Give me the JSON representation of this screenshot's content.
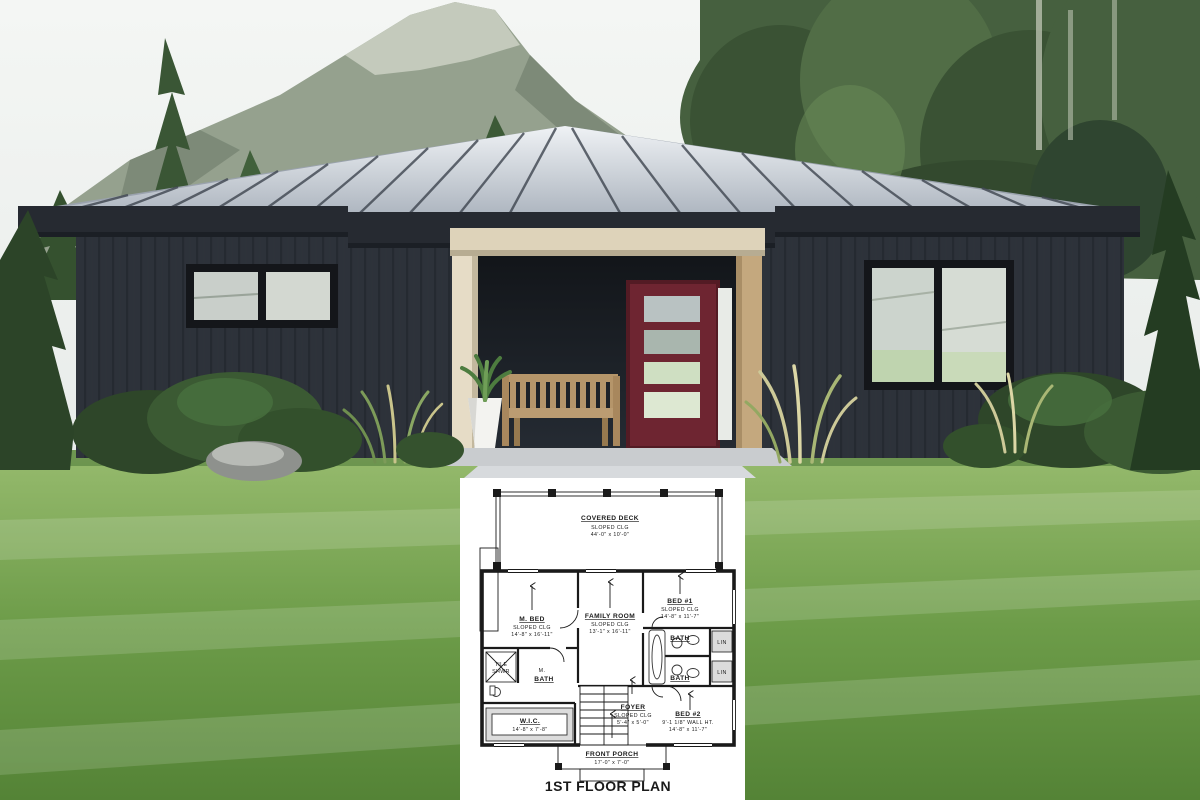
{
  "palette": {
    "sky": "#eef0ef",
    "mountain": "#93a08d",
    "forest": "#47603e",
    "roof_metal": "#c9d0d8",
    "fascia": "#262a31",
    "siding": "#2d323a",
    "porch_trim": "#ded3ba",
    "porch_wood": "#c4a87e",
    "front_door": "#6e2531",
    "lawn": "#6fa04c",
    "plan_ink": "#1a1a1a"
  },
  "floor_plan": {
    "caption": "1ST FLOOR PLAN",
    "covered_deck": {
      "name": "COVERED DECK",
      "ceiling": "SLOPED CLG",
      "dims": "44'-0\" x 10'-0\""
    },
    "m_bed": {
      "name": "M. BED",
      "ceiling": "SLOPED CLG",
      "dims": "14'-8\" x 16'-11\""
    },
    "family_room": {
      "name": "FAMILY ROOM",
      "ceiling": "SLOPED CLG",
      "dims": "13'-1\" x 16'-11\""
    },
    "bed_1": {
      "name": "BED #1",
      "ceiling": "SLOPED CLG",
      "dims": "14'-8\" x 11'-7\""
    },
    "bath_upper": {
      "name": "BATH"
    },
    "bath_lower": {
      "name": "BATH"
    },
    "lin_upper": {
      "name": "LIN"
    },
    "lin_lower": {
      "name": "LIN"
    },
    "tile_shwr": {
      "line1": "TILE",
      "line2": "SHWR"
    },
    "m_bath": {
      "line1": "M.",
      "line2": "BATH"
    },
    "wic": {
      "name": "W.I.C.",
      "dims": "14'-8\" x 7'-8\""
    },
    "foyer": {
      "name": "FOYER",
      "ceiling": "SLOPED CLG",
      "dims": "5'-4\" x 5'-0\""
    },
    "bed_2": {
      "name": "BED #2",
      "wall_height": "9'-1 1/8\" WALL HT.",
      "dims": "14'-8\" x 11'-7\""
    },
    "front_porch": {
      "name": "FRONT PORCH",
      "dims": "17'-0\" x 7'-0\""
    }
  }
}
